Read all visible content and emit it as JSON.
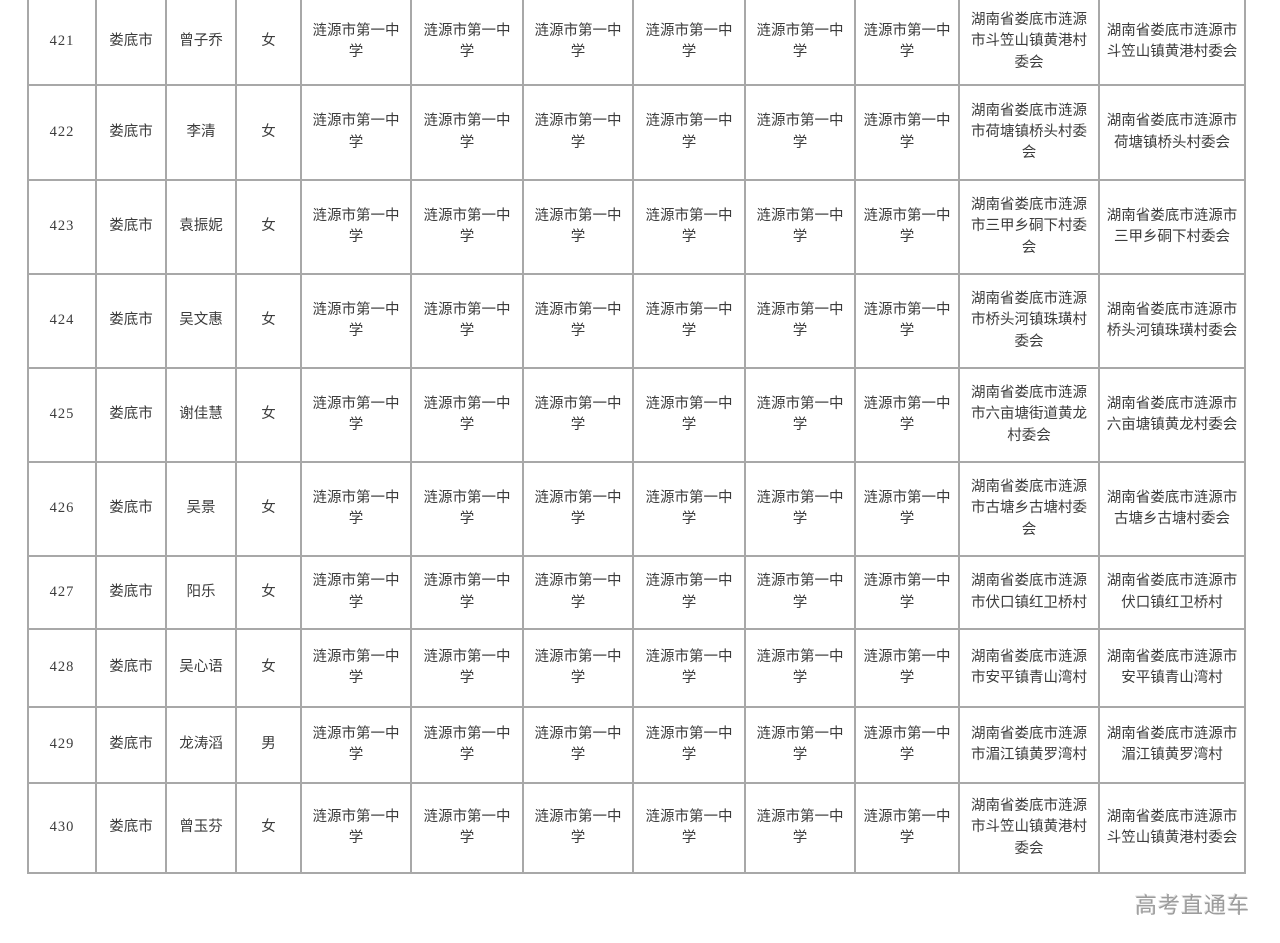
{
  "page": {
    "watermark": "高考直通车"
  },
  "colors": {
    "border": "#a8a8a8",
    "text": "#3c3c3c",
    "watermark": "#9c9c9c",
    "background": "#ffffff"
  },
  "table": {
    "rows": [
      [
        "421",
        "娄底市",
        "曾子乔",
        "女",
        "涟源市第一中学",
        "涟源市第一中学",
        "涟源市第一中学",
        "涟源市第一中学",
        "涟源市第一中学",
        "涟源市第一中学",
        "湖南省娄底市涟源市斗笠山镇黄港村委会",
        "湖南省娄底市涟源市斗笠山镇黄港村委会"
      ],
      [
        "422",
        "娄底市",
        "李清",
        "女",
        "涟源市第一中学",
        "涟源市第一中学",
        "涟源市第一中学",
        "涟源市第一中学",
        "涟源市第一中学",
        "涟源市第一中学",
        "湖南省娄底市涟源市荷塘镇桥头村委会",
        "湖南省娄底市涟源市荷塘镇桥头村委会"
      ],
      [
        "423",
        "娄底市",
        "袁振妮",
        "女",
        "涟源市第一中学",
        "涟源市第一中学",
        "涟源市第一中学",
        "涟源市第一中学",
        "涟源市第一中学",
        "涟源市第一中学",
        "湖南省娄底市涟源市三甲乡硐下村委会",
        "湖南省娄底市涟源市三甲乡硐下村委会"
      ],
      [
        "424",
        "娄底市",
        "吴文惠",
        "女",
        "涟源市第一中学",
        "涟源市第一中学",
        "涟源市第一中学",
        "涟源市第一中学",
        "涟源市第一中学",
        "涟源市第一中学",
        "湖南省娄底市涟源市桥头河镇珠璜村委会",
        "湖南省娄底市涟源市桥头河镇珠璜村委会"
      ],
      [
        "425",
        "娄底市",
        "谢佳慧",
        "女",
        "涟源市第一中学",
        "涟源市第一中学",
        "涟源市第一中学",
        "涟源市第一中学",
        "涟源市第一中学",
        "涟源市第一中学",
        "湖南省娄底市涟源市六亩塘街道黄龙村委会",
        "湖南省娄底市涟源市六亩塘镇黄龙村委会"
      ],
      [
        "426",
        "娄底市",
        "吴景",
        "女",
        "涟源市第一中学",
        "涟源市第一中学",
        "涟源市第一中学",
        "涟源市第一中学",
        "涟源市第一中学",
        "涟源市第一中学",
        "湖南省娄底市涟源市古塘乡古塘村委会",
        "湖南省娄底市涟源市古塘乡古塘村委会"
      ],
      [
        "427",
        "娄底市",
        "阳乐",
        "女",
        "涟源市第一中学",
        "涟源市第一中学",
        "涟源市第一中学",
        "涟源市第一中学",
        "涟源市第一中学",
        "涟源市第一中学",
        "湖南省娄底市涟源市伏口镇红卫桥村",
        "湖南省娄底市涟源市伏口镇红卫桥村"
      ],
      [
        "428",
        "娄底市",
        "吴心语",
        "女",
        "涟源市第一中学",
        "涟源市第一中学",
        "涟源市第一中学",
        "涟源市第一中学",
        "涟源市第一中学",
        "涟源市第一中学",
        "湖南省娄底市涟源市安平镇青山湾村",
        "湖南省娄底市涟源市安平镇青山湾村"
      ],
      [
        "429",
        "娄底市",
        "龙涛滔",
        "男",
        "涟源市第一中学",
        "涟源市第一中学",
        "涟源市第一中学",
        "涟源市第一中学",
        "涟源市第一中学",
        "涟源市第一中学",
        "湖南省娄底市涟源市湄江镇黄罗湾村",
        "湖南省娄底市涟源市湄江镇黄罗湾村"
      ],
      [
        "430",
        "娄底市",
        "曾玉芬",
        "女",
        "涟源市第一中学",
        "涟源市第一中学",
        "涟源市第一中学",
        "涟源市第一中学",
        "涟源市第一中学",
        "涟源市第一中学",
        "湖南省娄底市涟源市斗笠山镇黄港村委会",
        "湖南省娄底市涟源市斗笠山镇黄港村委会"
      ]
    ]
  }
}
